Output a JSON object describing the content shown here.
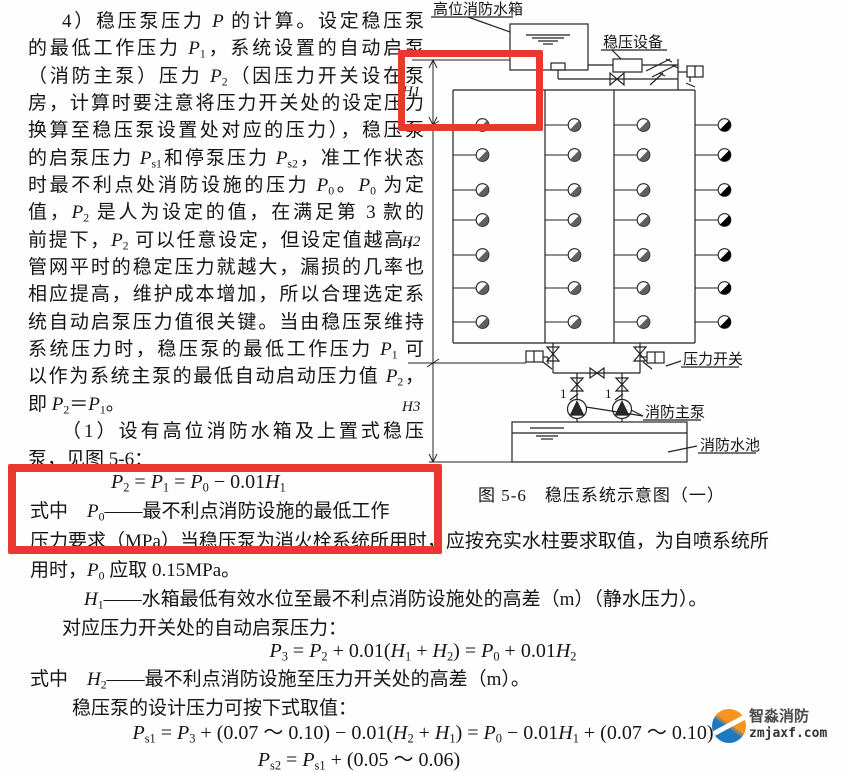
{
  "text": {
    "para_lines": [
      "4）稳压泵压力 $P$ 的计算。设定稳压泵",
      "的最低工作压力 $P$_{1}，系统设置的自动启泵",
      "（消防主泵）压力 $P$_{2}（因压力开关设在泵",
      "房，计算时要注意将压力开关处的设定压力",
      "换算至稳压泵设置处对应的压力），稳压泵",
      "的启泵压力 $P$_{s1}和停泵压力 $P$_{s2}，准工作状态",
      "时最不利点处消防设施的压力 $P$_{0}。$P$_{0} 为定",
      "值，$P$_{2} 是人为设定的值，在满足第 3 款的",
      "前提下，$P$_{2} 可以任意设定，但设定值越高，",
      "管网平时的稳定压力就越大，漏损的几率也",
      "相应提高，维护成本增加，所以合理选定系",
      "统自动启泵压力值很关键。当由稳压泵维持",
      "系统压力时，稳压泵的最低工作压力 $P$_{1} 可",
      "以作为系统主泵的最低自动启动压力值 $P$_{2}，",
      "即 $P$_{2}＝$P$_{1}。",
      "（1）设有高位消防水箱及上置式稳压",
      "泵，见图 5-6："
    ],
    "formula1": "$P$_{2} = $P$_{1} = $P$_{0} − 0.01$H$_{1}",
    "line_shizhong_p0": "式中　$P$_{0}——最不利点消防设施的最低工作",
    "line_pressure_req": "压力要求（MPa）当稳压泵为消火栓系统所用时，应按充实水柱要求取值，为自喷系统所",
    "line_yongshi": "用时，$P$_{0} 应取 0.15MPa。",
    "line_h1_def": "$H$_{1}——水箱最低有效水位至最不利点消防设施处的高差（m）（静水压力）。",
    "line_duiying": "对应压力开关处的自动启泵压力：",
    "formula2": "$P$_{3} = $P$_{2} + 0.01($H$_{1} + $H$_{2}) = $P$_{0} + 0.01$H$_{2}",
    "line_shizhong_h2": "式中　$H$_{2}——最不利点消防设施至压力开关处的高差（m）。",
    "line_wenyabeng": "稳压泵的设计压力可按下式取值：",
    "formula3": "$P$_{s1} = $P$_{3} + (0.07 ～ 0.10) − 0.01($H$_{2} + $H$_{1}) = $P$_{0} − 0.01$H$_{1} + (0.07 ～ 0.10)",
    "formula4": "$P$_{s2} = $P$_{s1} + (0.05 ～ 0.06)"
  },
  "diagram": {
    "caption": "图 5-6　稳压系统示意图（一）",
    "labels": {
      "tank": "高位消防水箱",
      "stabilizer": "稳压设备",
      "pressure_switch": "压力开关",
      "main_pumps": "消防主泵",
      "pool": "消防水池",
      "h1": "H1",
      "h2": "H2",
      "h3": "H3",
      "pump_no_1": "1",
      "pump_no_2": "1"
    }
  },
  "watermark": {
    "brand": "智淼消防",
    "domain": "zmjaxf.com"
  }
}
